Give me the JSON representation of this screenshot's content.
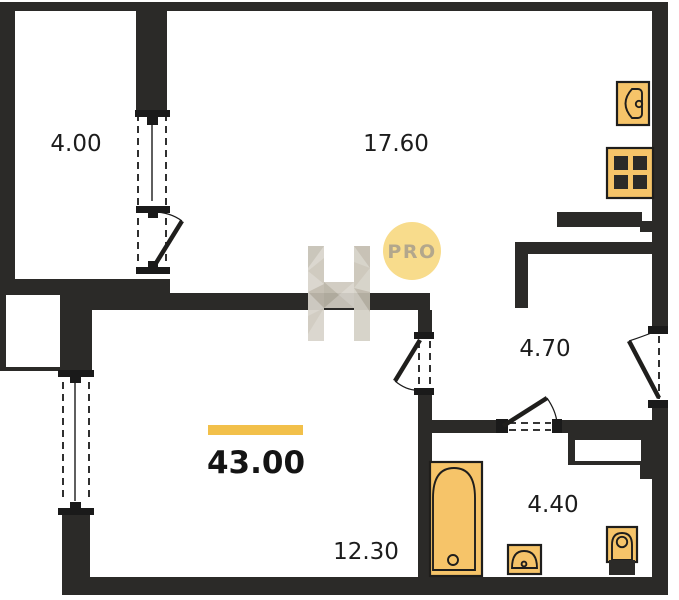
{
  "plan": {
    "type": "apartment-floor-plan",
    "total_area": "43.00",
    "rooms": [
      {
        "id": "balcony",
        "area": "4.00"
      },
      {
        "id": "living-kitchen",
        "area": "17.60"
      },
      {
        "id": "hallway",
        "area": "4.70"
      },
      {
        "id": "bathroom",
        "area": "4.40"
      },
      {
        "id": "bedroom",
        "area": "12.30"
      }
    ],
    "fixtures": [
      "kitchen-sink",
      "stove",
      "bathtub",
      "washbasin",
      "toilet"
    ],
    "watermark": {
      "badge_text": "PRO",
      "logo": "H-logo"
    },
    "colors": {
      "wall": "#2b2a28",
      "line": "#1a1a1a",
      "fixture_fill": "#f6c469",
      "accent_bar": "#f2c04a",
      "badge_fill": "#f8dc8c",
      "badge_text": "#b3a78c",
      "watermark_gray": "#cfcabf",
      "background": "#ffffff",
      "label_text": "#1c1c1c"
    }
  }
}
